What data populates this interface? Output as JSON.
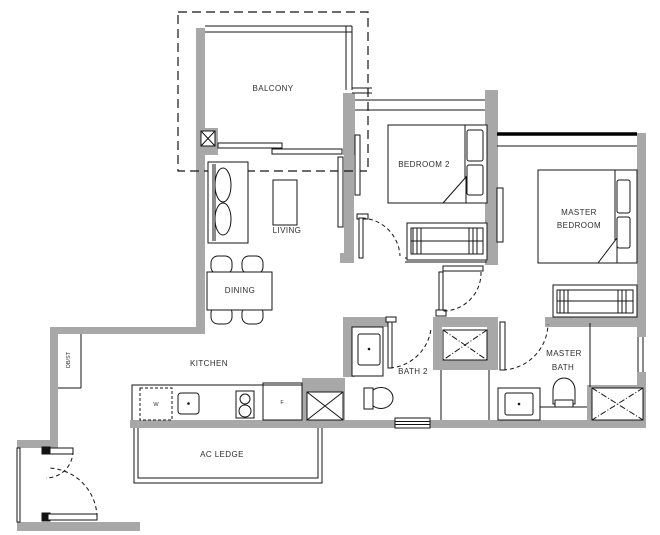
{
  "colors": {
    "wall": "#a8a8a8",
    "line": "#141414",
    "text": "#2e2e2e",
    "background": "#ffffff"
  },
  "rooms": {
    "balcony": {
      "label": "BALCONY"
    },
    "living": {
      "label": "LIVING"
    },
    "dining": {
      "label": "DINING"
    },
    "kitchen": {
      "label": "KITCHEN"
    },
    "bedroom2": {
      "label": "BEDROOM 2"
    },
    "master_bedroom": {
      "label_line1": "MASTER",
      "label_line2": "BEDROOM"
    },
    "bath2": {
      "label": "BATH 2"
    },
    "master_bath": {
      "label_line1": "MASTER",
      "label_line2": "BATH"
    },
    "ac_ledge": {
      "label": "AC LEDGE"
    },
    "db_st": {
      "label": "DB/ST"
    }
  },
  "appliances": {
    "washer": "W",
    "fridge": "F"
  }
}
